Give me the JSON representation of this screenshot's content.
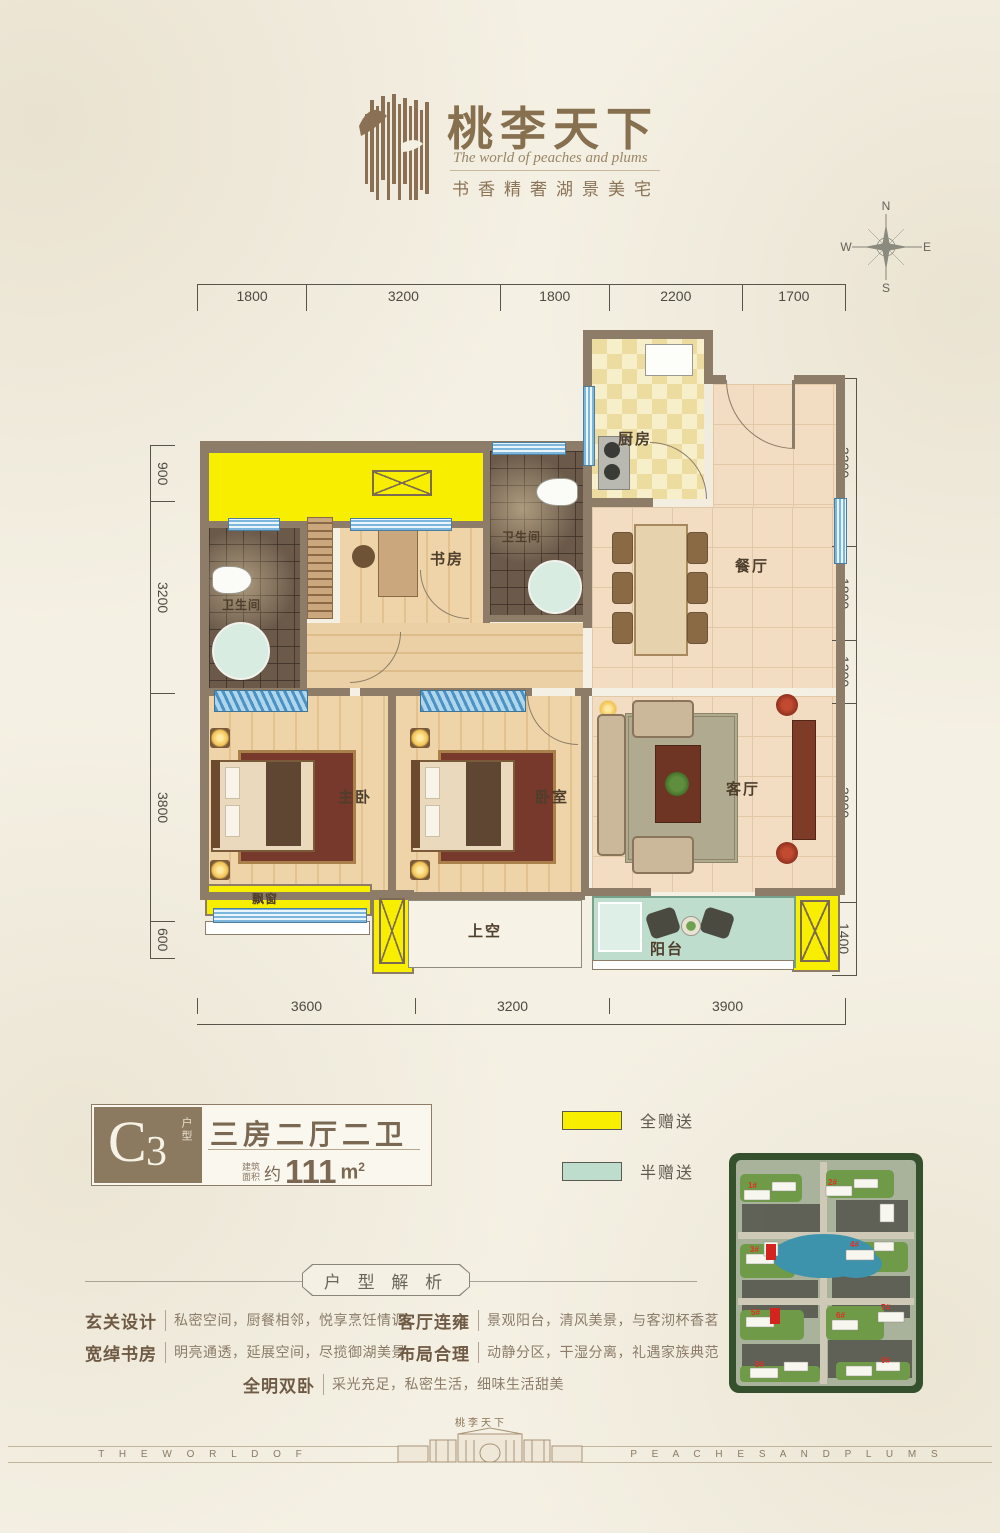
{
  "header": {
    "title": "桃李天下",
    "subtitle_en": "The world of peaches and plums",
    "tagline": "书香精奢湖景美宅"
  },
  "compass": {
    "n": "N",
    "s": "S",
    "e": "E",
    "w": "W"
  },
  "dims": {
    "top": [
      "1800",
      "3200",
      "1800",
      "2200",
      "1700"
    ],
    "left": [
      "900",
      "3200",
      "3800",
      "600"
    ],
    "right": [
      "3200",
      "1800",
      "1200",
      "3800",
      "1400"
    ],
    "bottom": [
      "3600",
      "3200",
      "3900"
    ]
  },
  "rooms": {
    "kitchen": "厨房",
    "dining": "餐厅",
    "study": "书房",
    "bath1": "卫生间",
    "bath2": "卫生间",
    "master": "主卧",
    "bedroom": "卧室",
    "living": "客厅",
    "balcony": "阳台",
    "bay": "飘窗",
    "void": "上空"
  },
  "unit": {
    "code_letter": "C",
    "code_digit": "3",
    "code_tag": "户型",
    "layout": "三房二厅二卫",
    "area_label_top": "建筑",
    "area_label_bottom": "面积",
    "area_prefix": "约",
    "area_value": "111",
    "area_unit": "m",
    "area_sup": "2"
  },
  "legend": [
    {
      "label": "全赠送",
      "color": "#f7ee00"
    },
    {
      "label": "半赠送",
      "color": "#bfddcc"
    }
  ],
  "siteplan": {
    "buildings": [
      "1#",
      "2#",
      "3#",
      "4#",
      "5#",
      "6#",
      "7#",
      "8#",
      "9#"
    ]
  },
  "analysis": {
    "heading": "户 型 解 析",
    "items": [
      {
        "label": "玄关设计",
        "text": "私密空间，厨餐相邻，悦享烹饪情调"
      },
      {
        "label": "客厅连雍",
        "text": "景观阳台，清风美景，与客沏杯香茗"
      },
      {
        "label": "宽绰书房",
        "text": "明亮通透，延展空间，尽揽御湖美景"
      },
      {
        "label": "布局合理",
        "text": "动静分区，干湿分离，礼遇家族典范"
      },
      {
        "label": "全明双卧",
        "text": "采光充足，私密生活，细味生活甜美"
      }
    ]
  },
  "footer": {
    "left": "T H E  W O R L D  O F",
    "right": "P E A C H E S  A N D  P L U M S",
    "gate_label": "桃李天下"
  },
  "colors": {
    "wall": "#8d7c68",
    "gift_full": "#f7ee00",
    "gift_half": "#bfddcc",
    "brand": "#8a7356",
    "window_blue": "#7db6dc"
  }
}
